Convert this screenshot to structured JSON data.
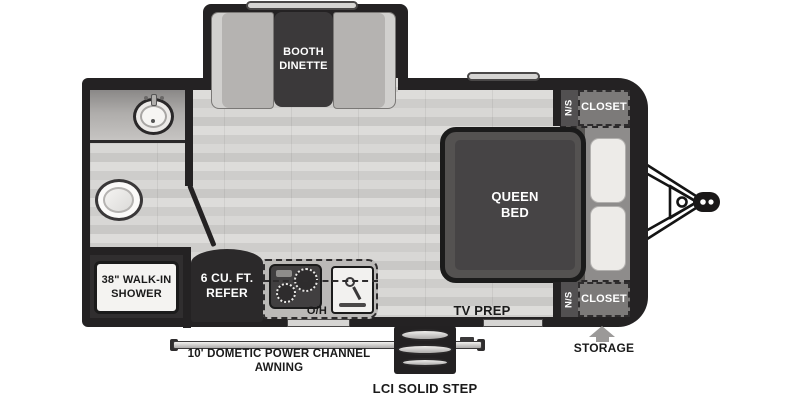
{
  "plan": {
    "dinette": {
      "label": "BOOTH DINETTE"
    },
    "bathroom": {
      "shower_label": "38\" WALK-IN SHOWER"
    },
    "kitchen": {
      "refrigerator_label": "6 CU. FT. REFER",
      "overhead_label": "O/H"
    },
    "bedroom": {
      "bed_label": "QUEEN BED",
      "tv_label": "TV PREP"
    },
    "closet_front_top": {
      "ns": "N/S",
      "label": "CLOSET"
    },
    "closet_front_bottom": {
      "ns": "N/S",
      "label": "CLOSET"
    },
    "exterior": {
      "awning_label": "10' DOMETIC POWER CHANNEL AWNING",
      "step_label": "LCI SOLID STEP",
      "storage_label": "STORAGE"
    }
  },
  "colors": {
    "wall": "#242223",
    "floor": "#d3d2d0",
    "bench": "#b5b3b1",
    "table": "#3b393a",
    "closet": "#7c7a79",
    "closet_ns_strip": "#525051",
    "bed_platform": "#545251",
    "mattress": "#464445",
    "pillow": "#edebe8",
    "counter": "#bbb9b7",
    "appliance_dark": "#2b292a",
    "shower": "#f4f3f1",
    "label_dark": "#1a1a1a",
    "label_light": "#ffffff"
  }
}
